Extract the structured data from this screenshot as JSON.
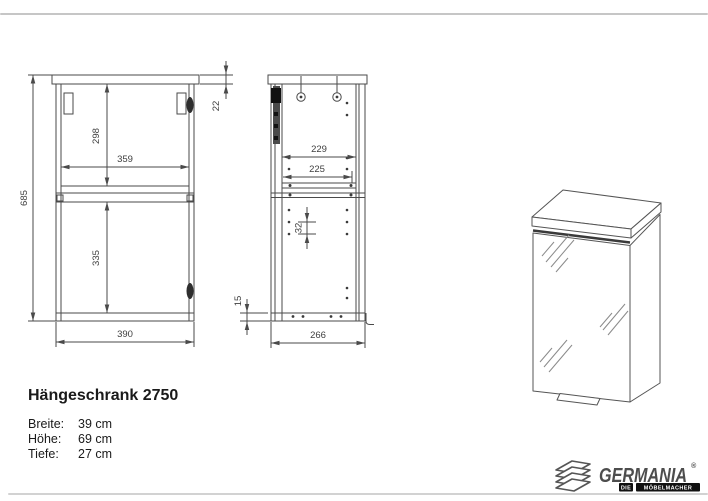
{
  "product": {
    "title": "Hängeschrank 2750",
    "specs": [
      {
        "label": "Breite:",
        "value": "39 cm"
      },
      {
        "label": "Höhe:",
        "value": "69 cm"
      },
      {
        "label": "Tiefe:",
        "value": "27 cm"
      }
    ]
  },
  "drawing": {
    "front_view": {
      "height_total": "685",
      "top_panel_thickness": "22",
      "upper_inner_height": "298",
      "inner_width": "359",
      "lower_inner_height": "335",
      "width_total": "390"
    },
    "side_view": {
      "inner_depth": "229",
      "shelf_depth": "225",
      "hole_pitch": "32",
      "bottom_panel": "15",
      "depth_total": "266"
    }
  },
  "brand": {
    "name": "GERMANIA",
    "registered": "®",
    "tagline_word1": "DIE",
    "tagline_word2": "MÖBELMACHER"
  },
  "colors": {
    "line": "#4a4a4a",
    "accent_dark": "#111111",
    "divider": "#c6c6c6"
  }
}
